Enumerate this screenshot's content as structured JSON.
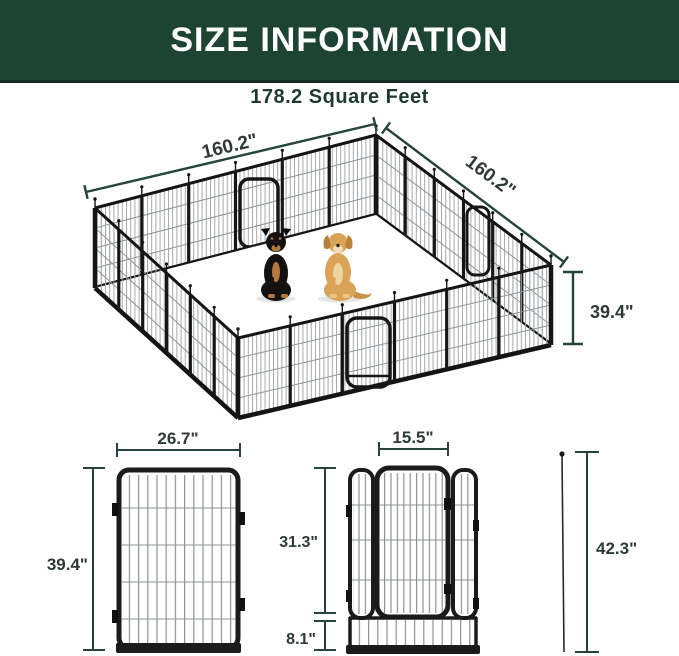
{
  "banner": {
    "title": "SIZE INFORMATION"
  },
  "subtitle": "178.2 Square Feet",
  "pen": {
    "area_label": "178.2 Square Feet",
    "top_left_width": "160.2\"",
    "top_right_width": "160.2\"",
    "height": "39.4\"",
    "dogs": [
      "rottweiler",
      "golden-retriever"
    ]
  },
  "panel_diagram": {
    "width": "26.7\"",
    "height": "39.4\""
  },
  "door_diagram": {
    "door_width": "15.5\"",
    "upper_height": "31.3\"",
    "bottom_height": "8.1\"",
    "stake_height": "42.3\""
  },
  "colors": {
    "banner_green": "#1d4433",
    "text_green": "#1e3a2e",
    "dimension_line": "#26443a",
    "frame_black": "#1b1b1b",
    "mesh_gray": "#a4a9ac",
    "dog_golden": "#d9a458",
    "dog_rottweiler": "#141110",
    "dog_tan": "#b5793f"
  }
}
